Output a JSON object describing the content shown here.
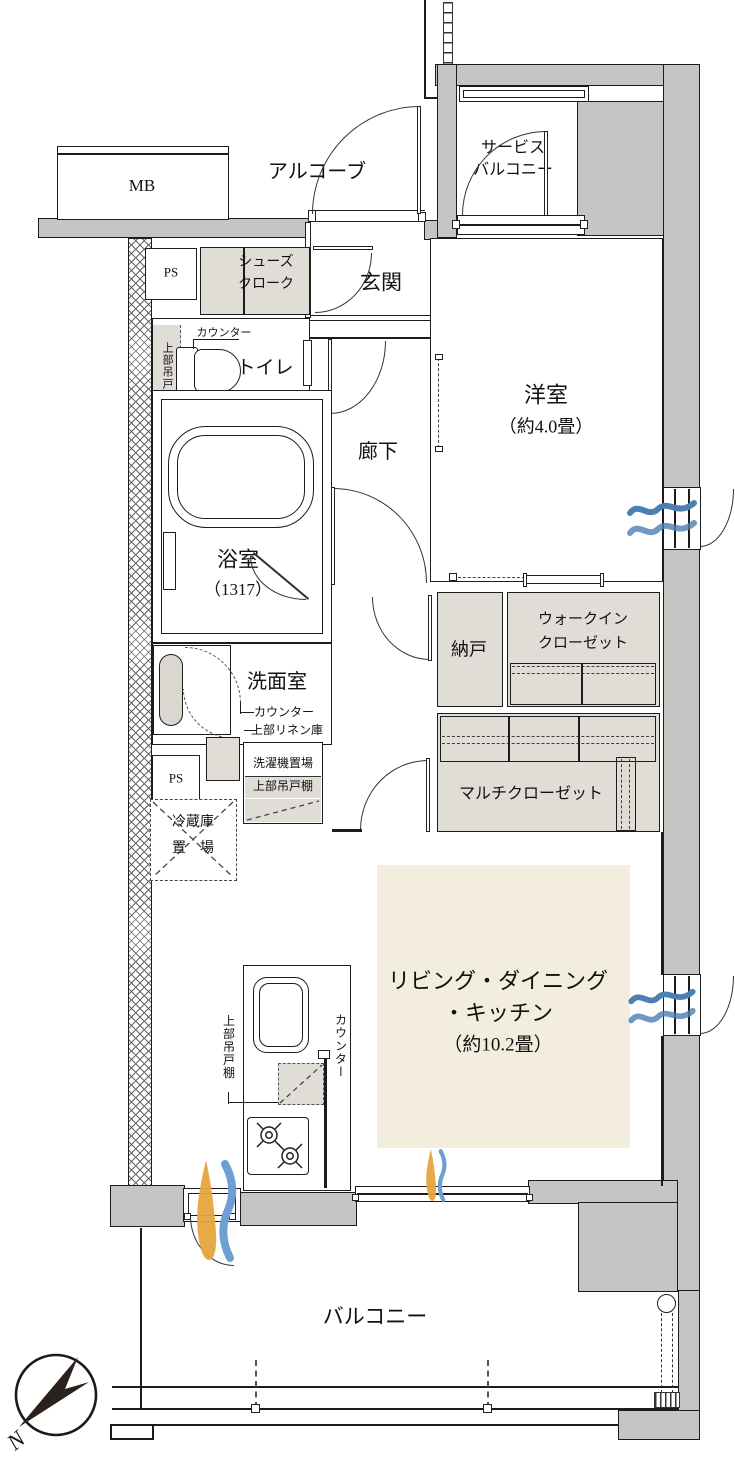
{
  "colors": {
    "wall_gray": "#c6c5c3",
    "closet_gray": "#e0ddd6",
    "ldk_cream": "#f3edde",
    "breeze_blue": "#4c80b2",
    "airflow_orange": "#e6a53c",
    "airflow_blue": "#6f9fd2",
    "line": "#1c1c1c"
  },
  "labels": {
    "mb": "MB",
    "ps": "PS",
    "alcove": "アルコーブ",
    "service_balcony": [
      "サービス",
      "バルコニー"
    ],
    "shoes_closet": [
      "シューズ",
      "クローク"
    ],
    "entrance": "玄関",
    "toilet": "トイレ",
    "corridor": "廊下",
    "counter": "カウンター",
    "upper_cabinet": "上部吊戸棚",
    "upper_linen": "上部リネン庫",
    "western_room": {
      "name": "洋室",
      "size": "（約4.0畳）"
    },
    "bathroom": {
      "name": "浴室",
      "size": "（1317）"
    },
    "storage": "納戸",
    "walk_in_closet": [
      "ウォークイン",
      "クローゼット"
    ],
    "multi_closet": "マルチクローゼット",
    "washroom": "洗面室",
    "laundry": "洗濯機置場",
    "refrigerator": [
      "冷蔵庫",
      "置　場"
    ],
    "ldk": [
      "リビング・ダイニング",
      "・キッチン",
      "（約10.2畳）"
    ],
    "balcony": "バルコニー",
    "compass_north": "N"
  },
  "icons": {
    "window_breeze": "wave-icon",
    "cross_ventilation": "airflow-flame-icon",
    "compass": "compass-north-icon",
    "stove": "gas-burner-icon",
    "drain": "drain-pipe-icon"
  }
}
